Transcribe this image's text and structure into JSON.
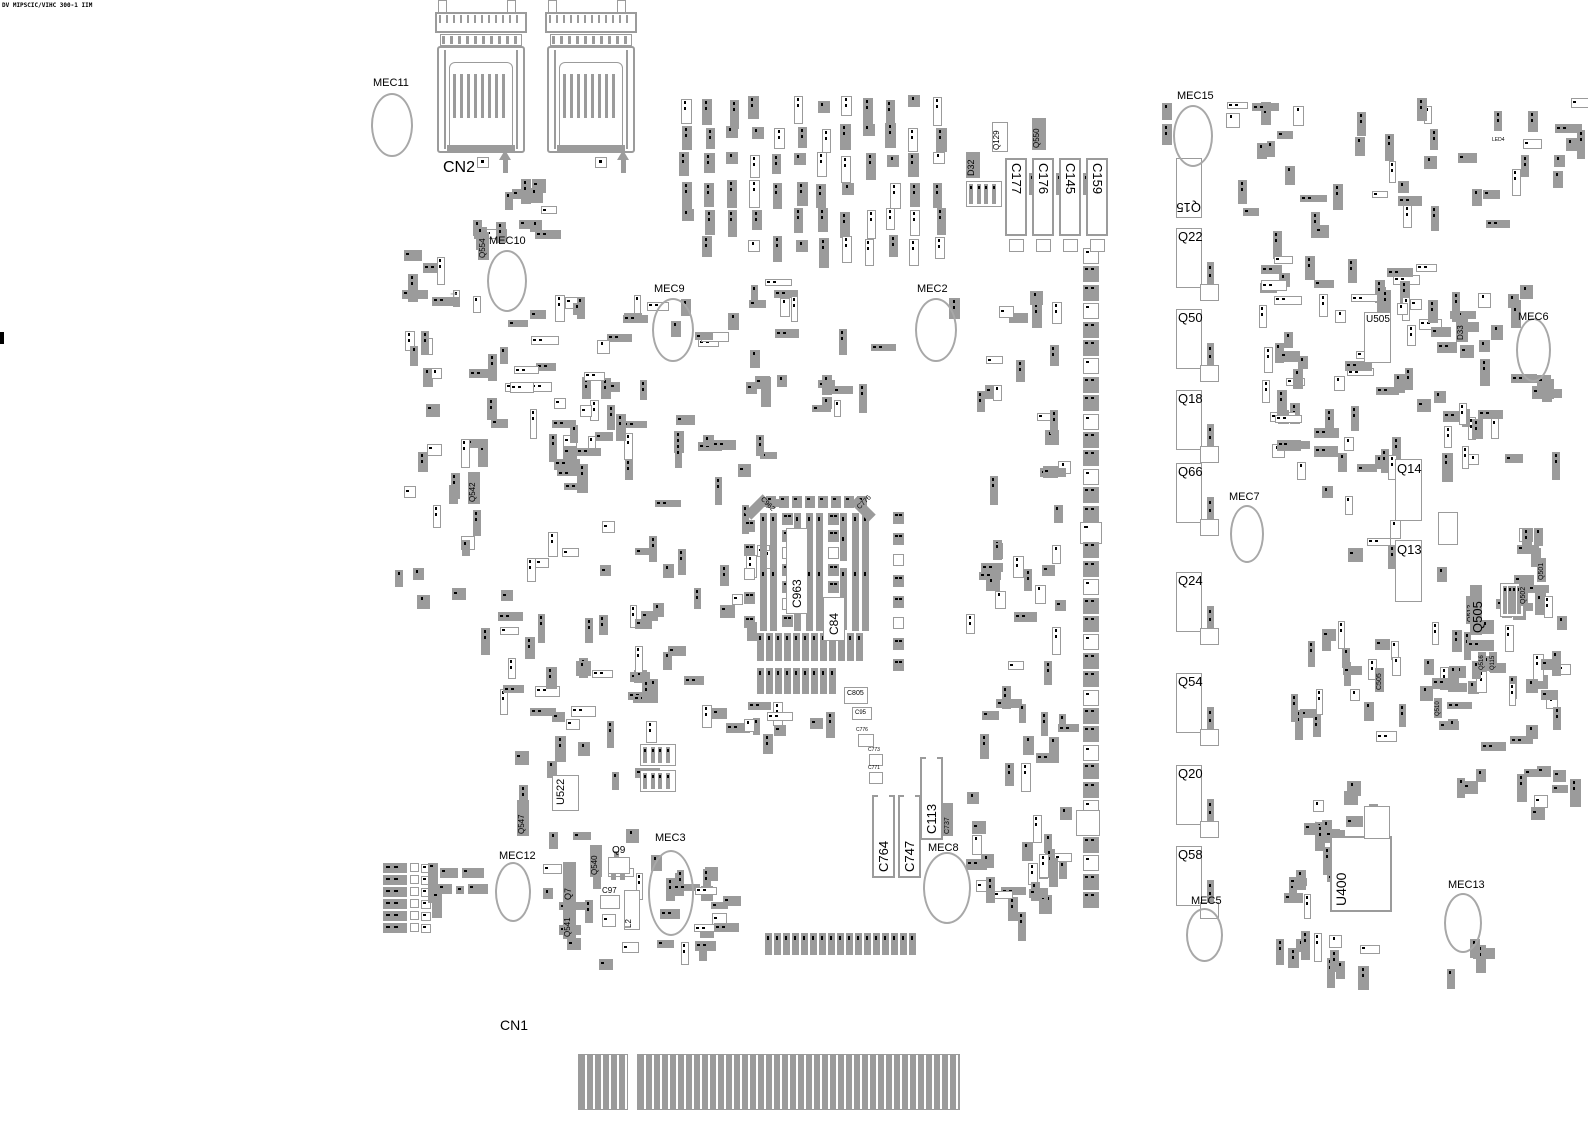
{
  "meta": {
    "width": 1588,
    "height": 1123,
    "bg": "#ffffff",
    "part_fill": "#9b9b9b",
    "outline_color": "#9b9b9b",
    "ellipse_color": "#a8a8a8",
    "text_color": "#000000",
    "title_text": "DV MIPSCIC/VIHC 300-1 IIM"
  },
  "connector_top": {
    "label": "CN2",
    "units": [
      {
        "x": 425
      },
      {
        "x": 535
      }
    ],
    "pads": [
      [
        477,
        157
      ],
      [
        595,
        157
      ]
    ],
    "pins": [
      [
        499,
        150
      ],
      [
        617,
        150
      ]
    ]
  },
  "connector_bottom": {
    "label": "CN1",
    "blocks": [
      [
        578,
        1054,
        50,
        56
      ],
      [
        637,
        1054,
        323,
        56
      ]
    ]
  },
  "fiducials": [
    {
      "label": "MEC11",
      "lx": 373,
      "ly": 78,
      "ex": 371,
      "ey": 93,
      "ew": 42,
      "eh": 64
    },
    {
      "label": "MEC10",
      "lx": 489,
      "ly": 236,
      "ex": 487,
      "ey": 250,
      "ew": 40,
      "eh": 62
    },
    {
      "label": "MEC9",
      "lx": 654,
      "ly": 284,
      "ex": 652,
      "ey": 298,
      "ew": 42,
      "eh": 64
    },
    {
      "label": "MEC2",
      "lx": 917,
      "ly": 284,
      "ex": 915,
      "ey": 298,
      "ew": 42,
      "eh": 64
    },
    {
      "label": "MEC15",
      "lx": 1177,
      "ly": 91,
      "ex": 1173,
      "ey": 105,
      "ew": 40,
      "eh": 62
    },
    {
      "label": "MEC6",
      "lx": 1518,
      "ly": 312,
      "ex": 1516,
      "ey": 318,
      "ew": 35,
      "eh": 64
    },
    {
      "label": "MEC7",
      "lx": 1229,
      "ly": 492,
      "ex": 1230,
      "ey": 505,
      "ew": 34,
      "eh": 58
    },
    {
      "label": "MEC3",
      "lx": 655,
      "ly": 833,
      "ex": 648,
      "ey": 850,
      "ew": 46,
      "eh": 86
    },
    {
      "label": "MEC8",
      "lx": 928,
      "ly": 843,
      "ex": 923,
      "ey": 852,
      "ew": 48,
      "eh": 72
    },
    {
      "label": "MEC12",
      "lx": 499,
      "ly": 851,
      "ex": 495,
      "ey": 862,
      "ew": 36,
      "eh": 60
    },
    {
      "label": "MEC5",
      "lx": 1191,
      "ly": 896,
      "ex": 1186,
      "ey": 908,
      "ew": 37,
      "eh": 54
    },
    {
      "label": "MEC13",
      "lx": 1448,
      "ly": 880,
      "ex": 1444,
      "ey": 893,
      "ew": 38,
      "eh": 60
    }
  ],
  "q_column": {
    "x": 1176,
    "w": 26,
    "h": 60,
    "items": [
      {
        "label": "Q15",
        "y": 158,
        "flip": true
      },
      {
        "label": "Q22",
        "y": 228
      },
      {
        "label": "Q50",
        "y": 309
      },
      {
        "label": "Q18",
        "y": 390
      },
      {
        "label": "Q66",
        "y": 463
      },
      {
        "label": "Q24",
        "y": 572
      },
      {
        "label": "Q54",
        "y": 673
      },
      {
        "label": "Q20",
        "y": 765
      },
      {
        "label": "Q58",
        "y": 846
      }
    ]
  },
  "caps_top": {
    "y": 158,
    "w": 22,
    "h": 78,
    "labels": [
      "C177",
      "C176",
      "C145",
      "C159"
    ],
    "xs": [
      1005,
      1032,
      1059,
      1086
    ]
  },
  "caps_mid": [
    {
      "label": "C764",
      "x": 872,
      "y": 795,
      "w": 23,
      "h": 83
    },
    {
      "label": "C747",
      "x": 898,
      "y": 795,
      "w": 23,
      "h": 83
    },
    {
      "label": "C113",
      "x": 920,
      "y": 757,
      "w": 23,
      "h": 83
    }
  ],
  "ics": [
    {
      "label": "Q14",
      "x": 1395,
      "y": 459,
      "w": 27,
      "h": 62,
      "fs": 13,
      "lpos": "in-top"
    },
    {
      "label": "Q13",
      "x": 1395,
      "y": 540,
      "w": 27,
      "h": 62,
      "fs": 13,
      "lpos": "in-top"
    },
    {
      "label": "U505",
      "x": 1364,
      "y": 312,
      "w": 27,
      "h": 51,
      "fs": 10,
      "lpos": "in-top"
    },
    {
      "label": "U400",
      "x": 1330,
      "y": 836,
      "w": 62,
      "h": 76,
      "fs": 14,
      "lpos": "left-rot"
    },
    {
      "label": "U522",
      "x": 552,
      "y": 775,
      "w": 27,
      "h": 36,
      "fs": 11,
      "lpos": "left-rot"
    }
  ],
  "rot_parts": [
    {
      "label": "Q554",
      "x": 478,
      "y": 232,
      "w": 11,
      "h": 28,
      "fs": 8
    },
    {
      "label": "Q542",
      "x": 468,
      "y": 472,
      "w": 12,
      "h": 32,
      "fs": 8
    },
    {
      "label": "D32",
      "x": 966,
      "y": 152,
      "w": 14,
      "h": 26,
      "fs": 9
    },
    {
      "label": "Q129",
      "x": 992,
      "y": 122,
      "w": 16,
      "h": 30,
      "fs": 8,
      "o": 1
    },
    {
      "label": "Q550",
      "x": 1032,
      "y": 118,
      "w": 14,
      "h": 32,
      "fs": 8
    },
    {
      "label": "D33",
      "x": 1456,
      "y": 316,
      "w": 12,
      "h": 26,
      "fs": 8
    },
    {
      "label": "C737",
      "x": 943,
      "y": 803,
      "w": 10,
      "h": 33,
      "fs": 7
    },
    {
      "label": "Q547",
      "x": 517,
      "y": 800,
      "w": 12,
      "h": 36,
      "fs": 8
    },
    {
      "label": "Q540",
      "x": 590,
      "y": 845,
      "w": 12,
      "h": 32,
      "fs": 8
    },
    {
      "label": "Q7",
      "x": 563,
      "y": 862,
      "w": 13,
      "h": 40,
      "fs": 9
    },
    {
      "label": "Q541",
      "x": 563,
      "y": 903,
      "w": 13,
      "h": 36,
      "fs": 8
    },
    {
      "label": "L2",
      "x": 624,
      "y": 890,
      "w": 16,
      "h": 40,
      "fs": 8,
      "o": 1
    },
    {
      "label": "Q512",
      "x": 1466,
      "y": 596,
      "w": 10,
      "h": 28,
      "fs": 7
    },
    {
      "label": "Q505",
      "x": 1470,
      "y": 585,
      "w": 12,
      "h": 50,
      "fs": 13
    },
    {
      "label": "Q501",
      "x": 1537,
      "y": 558,
      "w": 9,
      "h": 24,
      "fs": 7
    },
    {
      "label": "Q502",
      "x": 1519,
      "y": 582,
      "w": 9,
      "h": 24,
      "fs": 7
    },
    {
      "label": "C505",
      "x": 1375,
      "y": 668,
      "w": 9,
      "h": 24,
      "fs": 7
    },
    {
      "label": "Q516",
      "x": 1478,
      "y": 652,
      "w": 8,
      "h": 20,
      "fs": 6
    },
    {
      "label": "Q115",
      "x": 1489,
      "y": 652,
      "w": 8,
      "h": 20,
      "fs": 6
    },
    {
      "label": "Q510",
      "x": 1434,
      "y": 698,
      "w": 8,
      "h": 20,
      "fs": 6
    },
    {
      "label": "R736",
      "x": 1440,
      "y": 514,
      "w": 7,
      "h": 28,
      "fs": 6
    },
    {
      "label": "R737",
      "x": 1449,
      "y": 514,
      "w": 7,
      "h": 28,
      "fs": 6
    },
    {
      "label": "R1315",
      "x": 1368,
      "y": 809,
      "w": 7,
      "h": 26,
      "fs": 6
    },
    {
      "label": "R1350",
      "x": 1380,
      "y": 809,
      "w": 7,
      "h": 26,
      "fs": 6
    }
  ],
  "boxes": [
    [
      1438,
      512,
      20,
      33
    ],
    [
      1364,
      806,
      26,
      33
    ],
    [
      1076,
      810,
      24,
      26
    ]
  ],
  "flat_labels": [
    {
      "label": "Q9",
      "x": 612,
      "y": 846,
      "fs": 10
    },
    {
      "label": "C97",
      "x": 602,
      "y": 887,
      "fs": 8
    },
    {
      "label": "C805",
      "x": 847,
      "y": 690,
      "fs": 7
    },
    {
      "label": "C95",
      "x": 855,
      "y": 710,
      "fs": 6
    },
    {
      "label": "C776",
      "x": 856,
      "y": 728,
      "fs": 5
    },
    {
      "label": "C773",
      "x": 868,
      "y": 748,
      "fs": 5
    },
    {
      "label": "C771",
      "x": 868,
      "y": 766,
      "fs": 5
    },
    {
      "label": "LED4",
      "x": 1492,
      "y": 138,
      "fs": 5
    }
  ],
  "white_boxes": [
    [
      600,
      895,
      20,
      14
    ],
    [
      844,
      687,
      24,
      17
    ],
    [
      852,
      707,
      20,
      13
    ],
    [
      858,
      734,
      16,
      13
    ],
    [
      869,
      754,
      14,
      12
    ],
    [
      869,
      772,
      14,
      12
    ],
    [
      608,
      857,
      22,
      17
    ]
  ],
  "legs": [
    [
      611,
      874,
      5,
      6
    ],
    [
      620,
      874,
      5,
      6
    ],
    [
      614,
      851,
      5,
      6
    ]
  ],
  "diag_parts": [
    {
      "label": "C962",
      "x": 752,
      "y": 494,
      "rot": 45
    },
    {
      "label": "C776",
      "x": 858,
      "y": 496,
      "rot": -45
    }
  ],
  "center_block": {
    "strips": [
      [
        760,
        513,
        7,
        118
      ],
      [
        770,
        513,
        7,
        118
      ],
      [
        806,
        513,
        7,
        118
      ],
      [
        816,
        513,
        7,
        118
      ],
      [
        852,
        513,
        7,
        118
      ],
      [
        862,
        513,
        7,
        118
      ],
      [
        794,
        513,
        7,
        48
      ],
      [
        794,
        573,
        7,
        58
      ],
      [
        840,
        513,
        7,
        48
      ],
      [
        840,
        568,
        7,
        62
      ]
    ],
    "squares": [
      {
        "x": 782,
        "y0": 513,
        "n": 7,
        "st": 17
      },
      {
        "x": 828,
        "y0": 513,
        "n": 5,
        "st": 17
      },
      {
        "x": 893,
        "y0": 512,
        "n": 8,
        "st": 21
      },
      {
        "x": 744,
        "y0": 520,
        "n": 5,
        "st": 24
      }
    ],
    "toprow": {
      "x0": 766,
      "y": 496,
      "n": 8,
      "st": 13
    },
    "rows": [
      {
        "x0": 757,
        "y": 633,
        "n": 12,
        "st": 9,
        "h": 28
      },
      {
        "x0": 757,
        "y": 668,
        "n": 9,
        "st": 9,
        "h": 26
      }
    ],
    "white_boxes": [
      {
        "label": "C963",
        "x": 786,
        "y": 528,
        "w": 22,
        "h": 86,
        "fs": 12
      },
      {
        "label": "C84",
        "x": 823,
        "y": 597,
        "w": 22,
        "h": 44,
        "fs": 12
      }
    ]
  },
  "pad_column": {
    "x": 1083,
    "y0": 248,
    "step": 18.4,
    "count": 36,
    "size": 16,
    "big_index": 15
  },
  "strip_row": {
    "x0": 765,
    "y": 933,
    "step": 9,
    "count": 17,
    "w": 7,
    "h": 22
  },
  "grid_rows": {
    "ys": [
      863,
      875,
      887,
      899,
      911,
      923
    ]
  },
  "bl_cluster": [
    [
      428,
      863,
      10,
      40
    ],
    [
      440,
      868,
      18,
      10
    ],
    [
      462,
      868,
      22,
      10
    ],
    [
      438,
      884,
      14,
      10
    ],
    [
      456,
      886,
      8,
      8
    ],
    [
      468,
      884,
      20,
      10
    ],
    [
      432,
      892,
      10,
      26
    ]
  ],
  "rgangs": [
    [
      966,
      181,
      36,
      26
    ],
    [
      1500,
      583,
      24,
      34
    ],
    [
      640,
      744,
      36,
      22
    ],
    [
      640,
      770,
      36,
      22
    ]
  ],
  "plus_marks": [
    [
      450,
      287
    ],
    [
      1312,
      818
    ]
  ],
  "marks": [
    [
      0,
      332,
      4,
      12
    ]
  ],
  "scatter": [
    {
      "x": 678,
      "y": 95,
      "w": 285,
      "h": 170,
      "n": 70,
      "s": 11,
      "g": 1
    },
    {
      "x": 690,
      "y": 270,
      "w": 260,
      "h": 115,
      "n": 12,
      "s": 12
    },
    {
      "x": 392,
      "y": 240,
      "w": 108,
      "h": 140,
      "n": 16,
      "s": 13
    },
    {
      "x": 478,
      "y": 295,
      "w": 130,
      "h": 160,
      "n": 22,
      "s": 14
    },
    {
      "x": 390,
      "y": 378,
      "w": 250,
      "h": 265,
      "n": 46,
      "s": 15
    },
    {
      "x": 482,
      "y": 650,
      "w": 175,
      "h": 138,
      "n": 26,
      "s": 16
    },
    {
      "x": 560,
      "y": 288,
      "w": 200,
      "h": 230,
      "n": 26,
      "s": 17
    },
    {
      "x": 602,
      "y": 522,
      "w": 165,
      "h": 205,
      "n": 24,
      "s": 18
    },
    {
      "x": 755,
      "y": 362,
      "w": 110,
      "h": 46,
      "n": 10,
      "s": 19
    },
    {
      "x": 962,
      "y": 272,
      "w": 100,
      "h": 365,
      "n": 34,
      "s": 20
    },
    {
      "x": 962,
      "y": 648,
      "w": 100,
      "h": 258,
      "n": 28,
      "s": 21
    },
    {
      "x": 1225,
      "y": 95,
      "w": 330,
      "h": 142,
      "n": 40,
      "s": 22
    },
    {
      "x": 1258,
      "y": 242,
      "w": 168,
      "h": 205,
      "n": 56,
      "s": 23
    },
    {
      "x": 1425,
      "y": 280,
      "w": 130,
      "h": 142,
      "n": 24,
      "s": 24
    },
    {
      "x": 1290,
      "y": 445,
      "w": 128,
      "h": 112,
      "n": 12,
      "s": 25
    },
    {
      "x": 1418,
      "y": 565,
      "w": 140,
      "h": 132,
      "n": 32,
      "s": 26
    },
    {
      "x": 1290,
      "y": 618,
      "w": 118,
      "h": 128,
      "n": 20,
      "s": 27
    },
    {
      "x": 1432,
      "y": 645,
      "w": 114,
      "h": 138,
      "n": 16,
      "s": 28
    },
    {
      "x": 1268,
      "y": 862,
      "w": 100,
      "h": 98,
      "n": 12,
      "s": 29
    },
    {
      "x": 540,
      "y": 828,
      "w": 185,
      "h": 132,
      "n": 36,
      "s": 30
    },
    {
      "x": 468,
      "y": 158,
      "w": 76,
      "h": 74,
      "n": 14,
      "s": 31
    },
    {
      "x": 975,
      "y": 840,
      "w": 85,
      "h": 72,
      "n": 14,
      "s": 32
    },
    {
      "x": 1522,
      "y": 690,
      "w": 55,
      "h": 128,
      "n": 8,
      "s": 33
    },
    {
      "x": 1300,
      "y": 925,
      "w": 60,
      "h": 44,
      "n": 6,
      "s": 34
    },
    {
      "x": 1555,
      "y": 95,
      "w": 28,
      "h": 58,
      "n": 4,
      "s": 35
    },
    {
      "x": 1430,
      "y": 360,
      "w": 128,
      "h": 98,
      "n": 10,
      "s": 36
    },
    {
      "x": 1510,
      "y": 468,
      "w": 40,
      "h": 80,
      "n": 5,
      "s": 37
    },
    {
      "x": 1296,
      "y": 788,
      "w": 38,
      "h": 70,
      "n": 8,
      "s": 38
    },
    {
      "x": 1344,
      "y": 775,
      "w": 30,
      "h": 55,
      "n": 4,
      "s": 39
    },
    {
      "x": 1148,
      "y": 98,
      "w": 22,
      "h": 32,
      "n": 2,
      "s": 40
    },
    {
      "x": 1430,
      "y": 925,
      "w": 50,
      "h": 46,
      "n": 4,
      "s": 41
    },
    {
      "x": 744,
      "y": 700,
      "w": 110,
      "h": 40,
      "n": 8,
      "s": 42
    },
    {
      "x": 700,
      "y": 430,
      "w": 60,
      "h": 80,
      "n": 6,
      "s": 43
    }
  ]
}
